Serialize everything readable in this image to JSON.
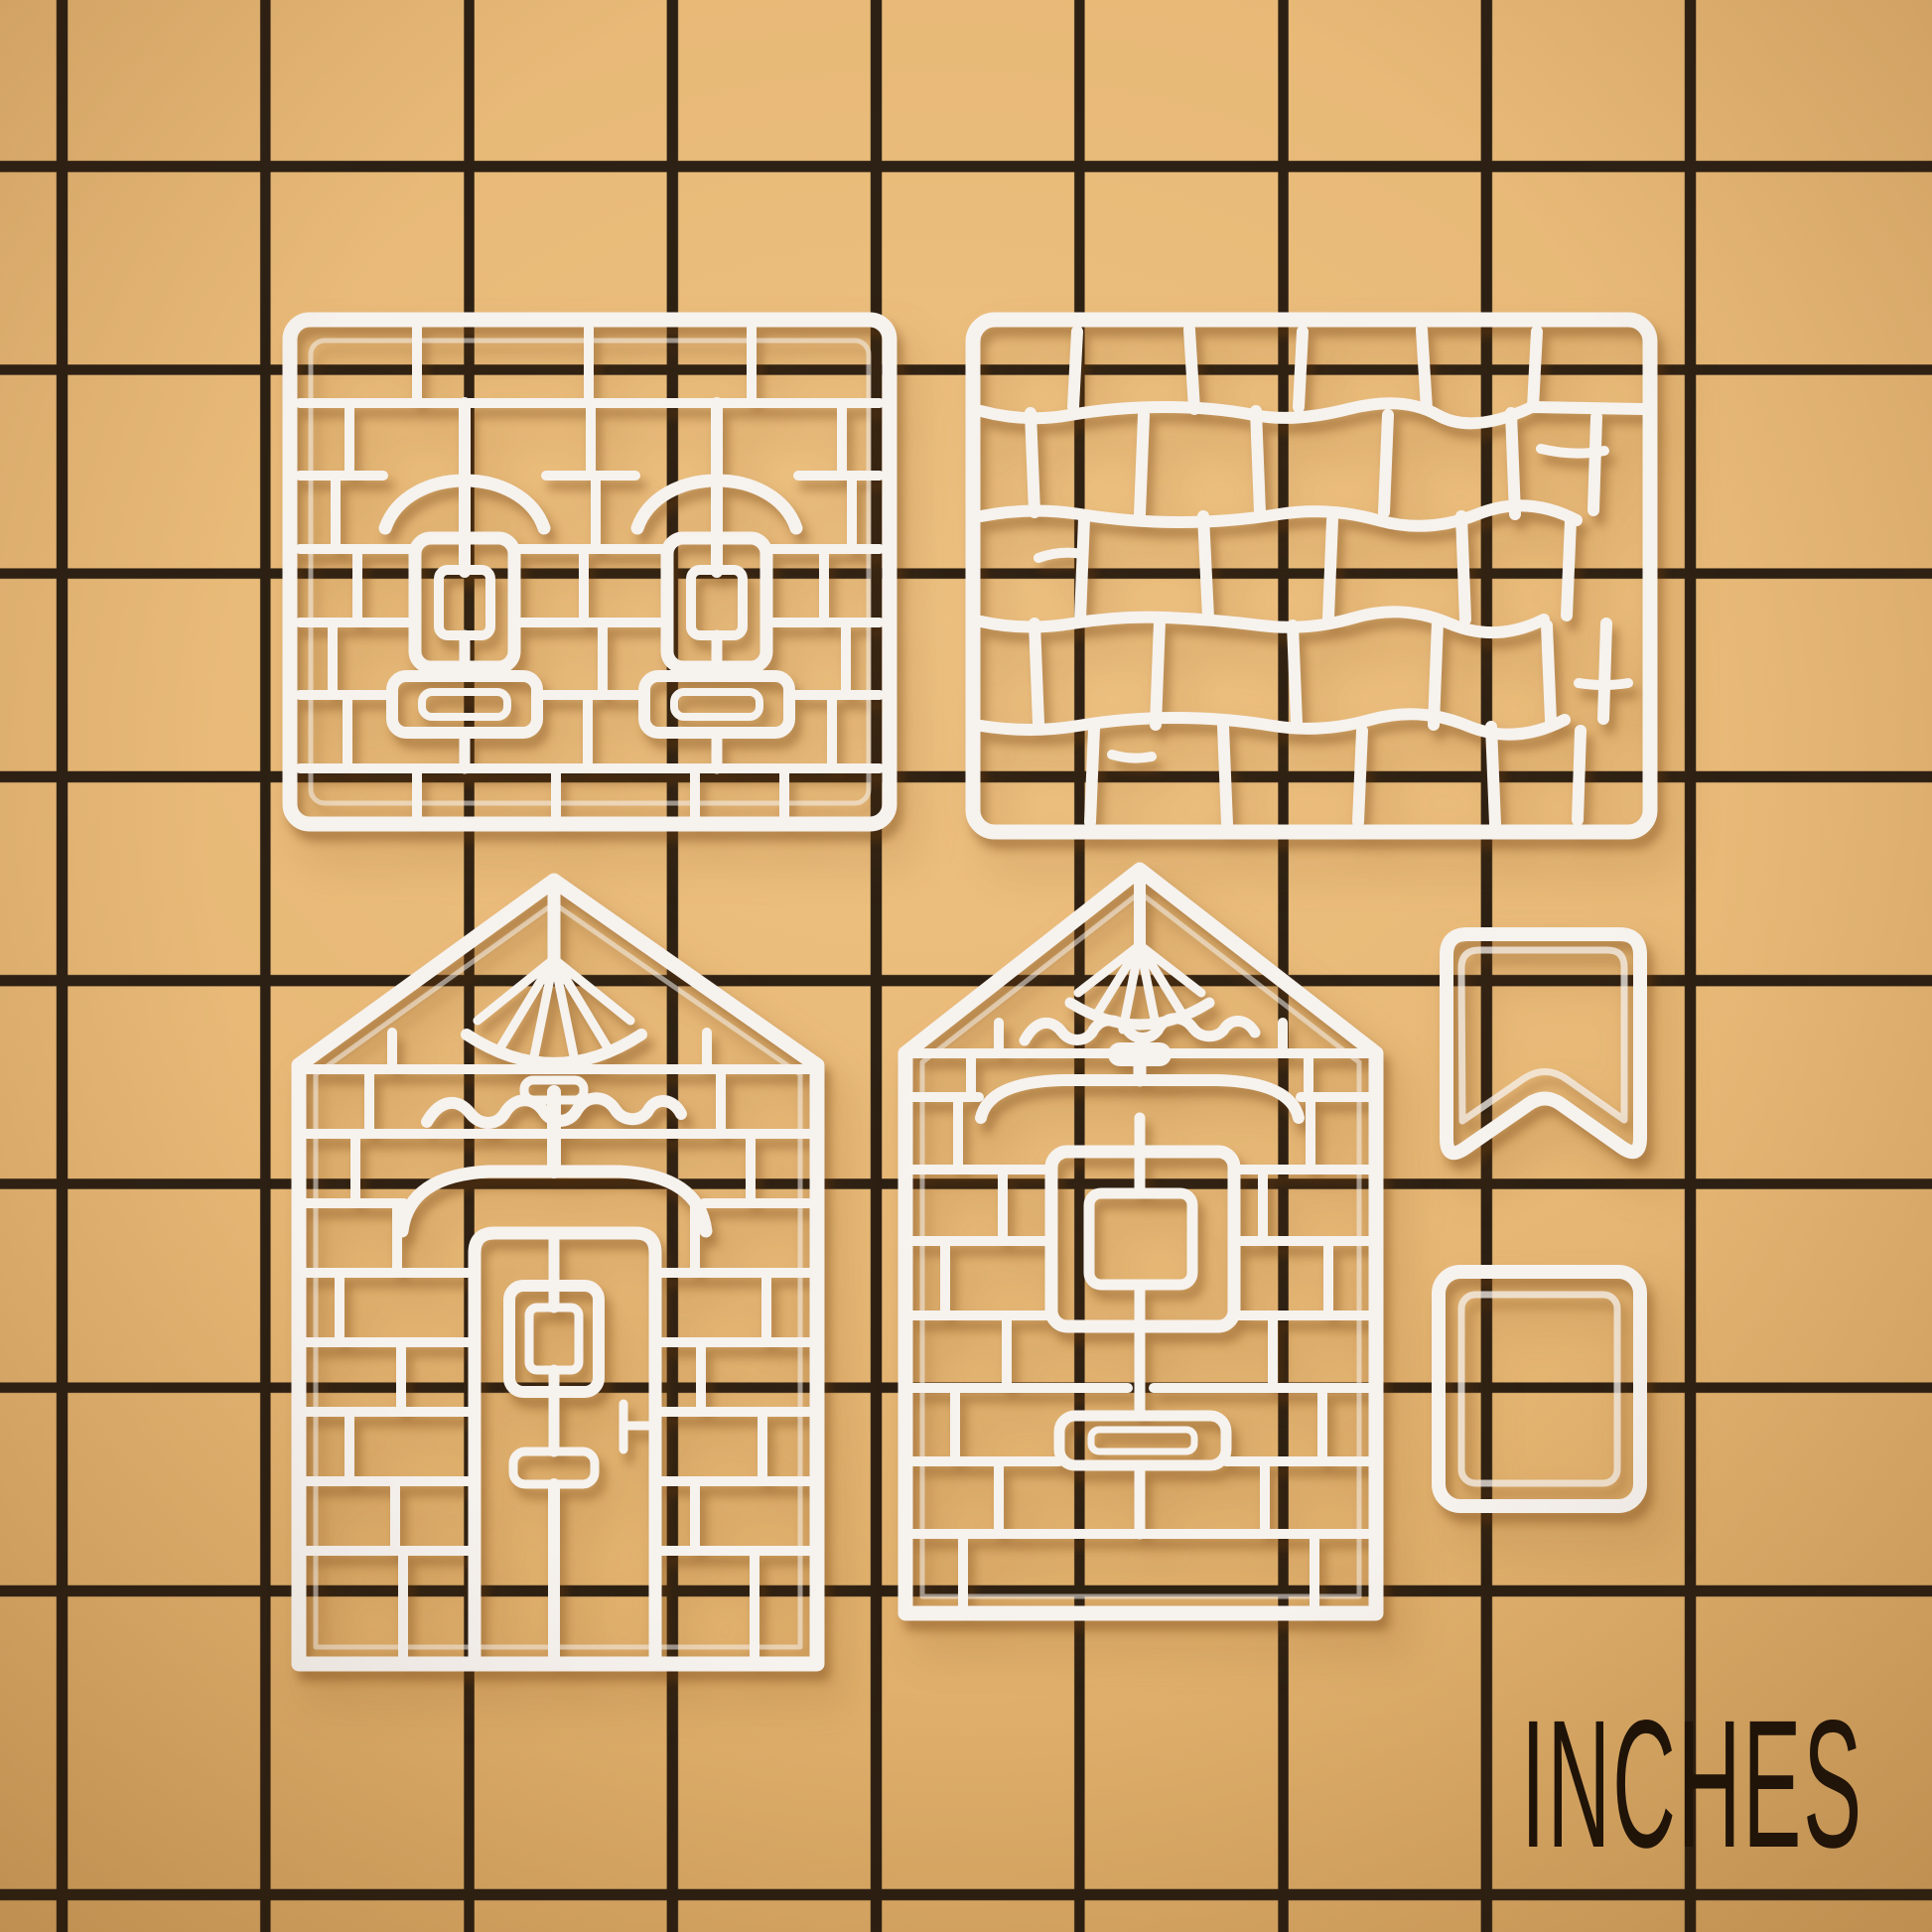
{
  "scene": {
    "description": "Photograph of six white 3D-printed gingerbread-house cookie cutters arranged on a tan craft cutting mat printed with a black one-inch grid",
    "mat_color": "#e2b26d",
    "grid_line_color": "#1d140c",
    "plastic_color": "#f6f2ee",
    "shadow_color": "#6e3c0c",
    "grid_spacing_px": 205
  },
  "scale_label": {
    "text": "INCHES"
  },
  "cutters": [
    {
      "id": "side-wall",
      "name": "brick side wall cutter with two windows",
      "position": "top-left"
    },
    {
      "id": "roof",
      "name": "cobblestone roof panel cutter",
      "position": "top-right"
    },
    {
      "id": "front-wall",
      "name": "front wall cutter with door, fan gable and icing trim",
      "position": "bottom-left"
    },
    {
      "id": "back-wall",
      "name": "back wall cutter with window, fan gable and icing trim",
      "position": "bottom-center"
    },
    {
      "id": "banner",
      "name": "small banner / bookmark cutter",
      "position": "right-upper"
    },
    {
      "id": "small-rect",
      "name": "small rectangle cutter",
      "position": "right-lower"
    }
  ]
}
